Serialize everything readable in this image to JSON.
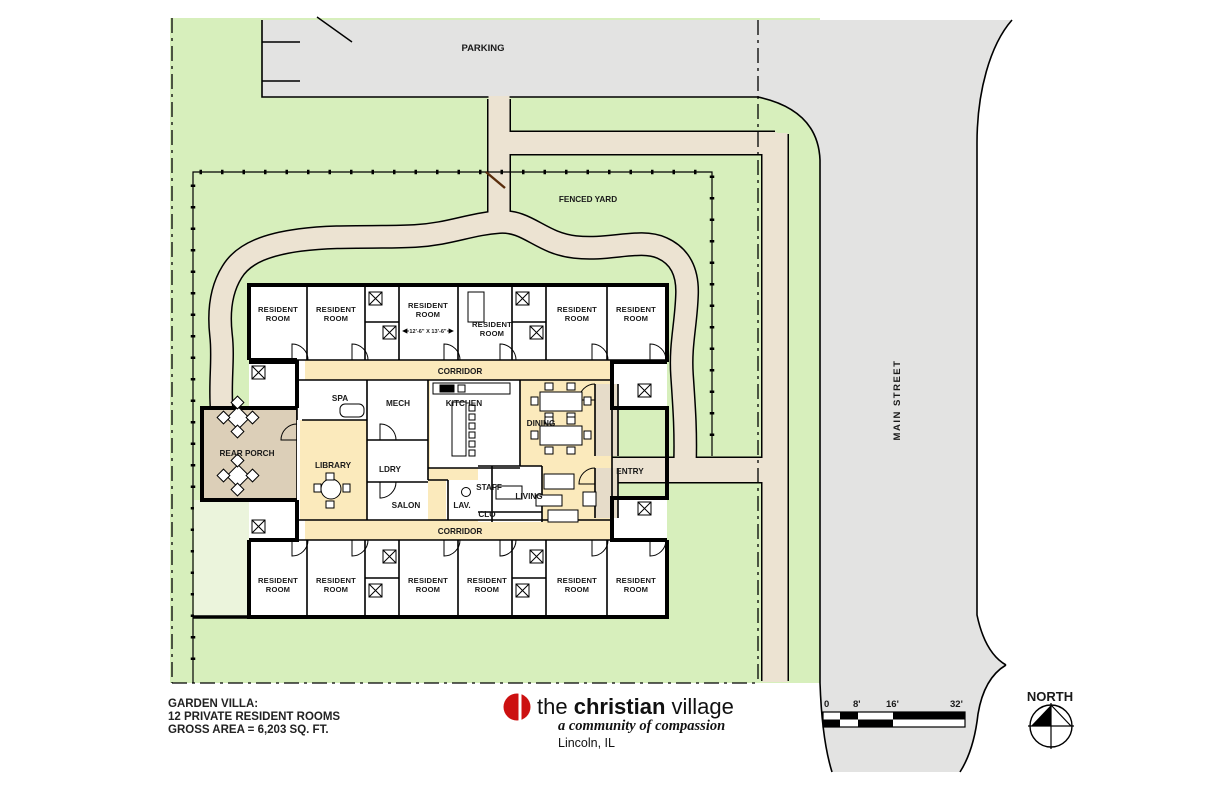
{
  "site": {
    "parking_label": "PARKING",
    "fenced_yard_label": "FENCED YARD",
    "main_street_label": "MAIN STREET",
    "entry_label": "ENTRY",
    "north_label": "NORTH"
  },
  "plan": {
    "corridor_top": "CORRIDOR",
    "corridor_bottom": "CORRIDOR",
    "room_dimension": "12'-6\" X 13'-6\"",
    "rooms": [
      {
        "l1": "RESIDENT",
        "l2": "ROOM"
      },
      {
        "l1": "RESIDENT",
        "l2": "ROOM"
      },
      {
        "l1": "RESIDENT",
        "l2": "ROOM"
      },
      {
        "l1": "RESIDENT",
        "l2": "ROOM"
      },
      {
        "l1": "RESIDENT",
        "l2": "ROOM"
      },
      {
        "l1": "RESIDENT",
        "l2": "ROOM"
      },
      {
        "l1": "RESIDENT",
        "l2": "ROOM"
      },
      {
        "l1": "RESIDENT",
        "l2": "ROOM"
      },
      {
        "l1": "RESIDENT",
        "l2": "ROOM"
      },
      {
        "l1": "RESIDENT",
        "l2": "ROOM"
      },
      {
        "l1": "RESIDENT",
        "l2": "ROOM"
      },
      {
        "l1": "RESIDENT",
        "l2": "ROOM"
      }
    ],
    "spaces": {
      "rear_porch": "REAR PORCH",
      "spa": "SPA",
      "library": "LIBRARY",
      "mech": "MECH",
      "ldry": "LDRY",
      "salon": "SALON",
      "kitchen": "KITCHEN",
      "lav": "LAV.",
      "staff": "STAFF",
      "clo": "CLO",
      "dining": "DINING",
      "living": "LIVING"
    }
  },
  "title_block": {
    "line1": "GARDEN VILLA:",
    "line2": "12 PRIVATE RESIDENT ROOMS",
    "line3": "GROSS AREA = 6,203 SQ. FT."
  },
  "logo": {
    "word1": "the ",
    "word2": "christian",
    "word3": " village",
    "tagline": "a community of compassion",
    "city": "Lincoln, IL"
  },
  "scale_bar": {
    "labels": [
      "0",
      "8'",
      "16'",
      "32'"
    ]
  },
  "colors": {
    "green": "#d7efbc",
    "pavement": "#e3e3e2",
    "path": "#ece3d2",
    "porch": "#dccfb8",
    "interior_cream": "#fbeabc",
    "vestibule": "#e6dcc9",
    "patio_pale": "#ebf4dc",
    "logo_red": "#cc1010"
  }
}
